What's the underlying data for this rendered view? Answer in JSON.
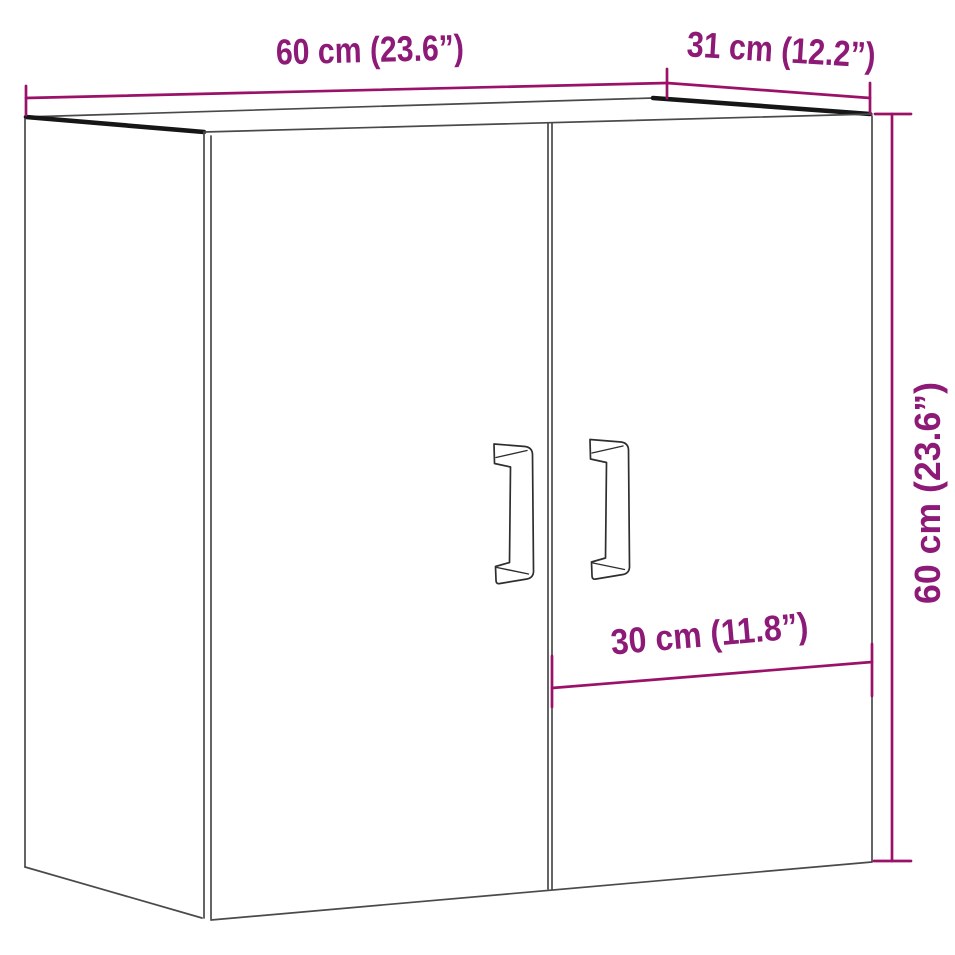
{
  "diagram": {
    "title": "Wall cabinet dimension diagram",
    "object": "two-door wall cabinet",
    "labels": {
      "width_top": "60 cm (23.6”)",
      "depth_top": "31 cm (12.2”)",
      "height_right": "60 cm (23.6”)",
      "door_width": "30 cm (11.8”)"
    },
    "colors": {
      "dimension_line": "#9C1168",
      "dimension_text": "#8D1A77",
      "outline": "#4A4A4A",
      "panel_edge": "#161616",
      "background": "#FFFFFF"
    }
  }
}
